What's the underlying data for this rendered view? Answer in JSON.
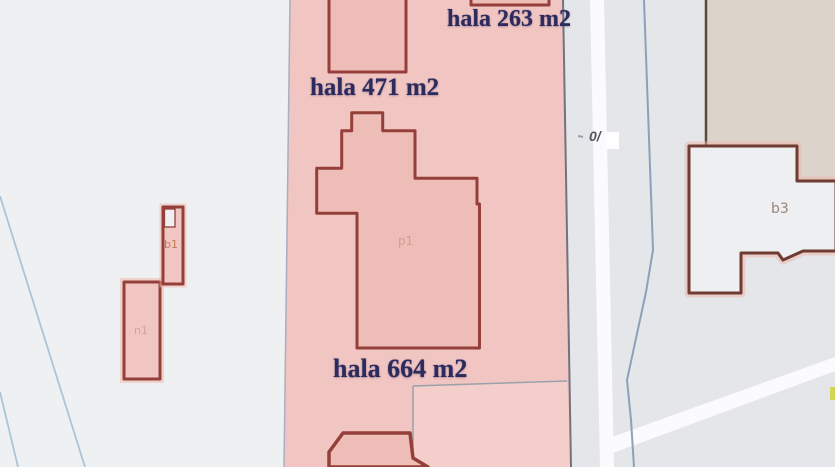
{
  "labels": {
    "hala_263": "hala 263 m2",
    "hala_471": "hala 471 m2",
    "hala_664": "hala 664 m2"
  },
  "codes": {
    "p1": "p1",
    "b1": "b1",
    "n1": "n1",
    "b3": "b3"
  },
  "road": {
    "label": "0/"
  },
  "colors": {
    "bg_left": "#eff0f2",
    "bg_right": "#e5e6e9",
    "parcel_pink": "#f1c5c1",
    "parcel_pink_light": "#f4ceca",
    "building_fill": "#efbdb7",
    "building_border": "#943f39",
    "b3_fill": "#edeff1",
    "b3_border": "#6f3b33",
    "tan_fill": "#dcd3cb",
    "tan_border": "#5c4a42",
    "road_white": "#fbfbfd",
    "creek_blue": "#8299b4",
    "field_line_blue": "#abc5d8",
    "parcel_border_left": "#a9aec0",
    "parcel_border_right": "#73737f",
    "division_line": "#9aa0ac",
    "label_navy": "#2d2b5e",
    "code_pink": "#d49b95",
    "code_orange": "#c07e4f",
    "code_rose": "#cda69e",
    "code_brown": "#97857a",
    "road_label_gray": "#54545e",
    "marker_yellow": "#d2d655",
    "glow_pink": "#f0b3a7"
  }
}
